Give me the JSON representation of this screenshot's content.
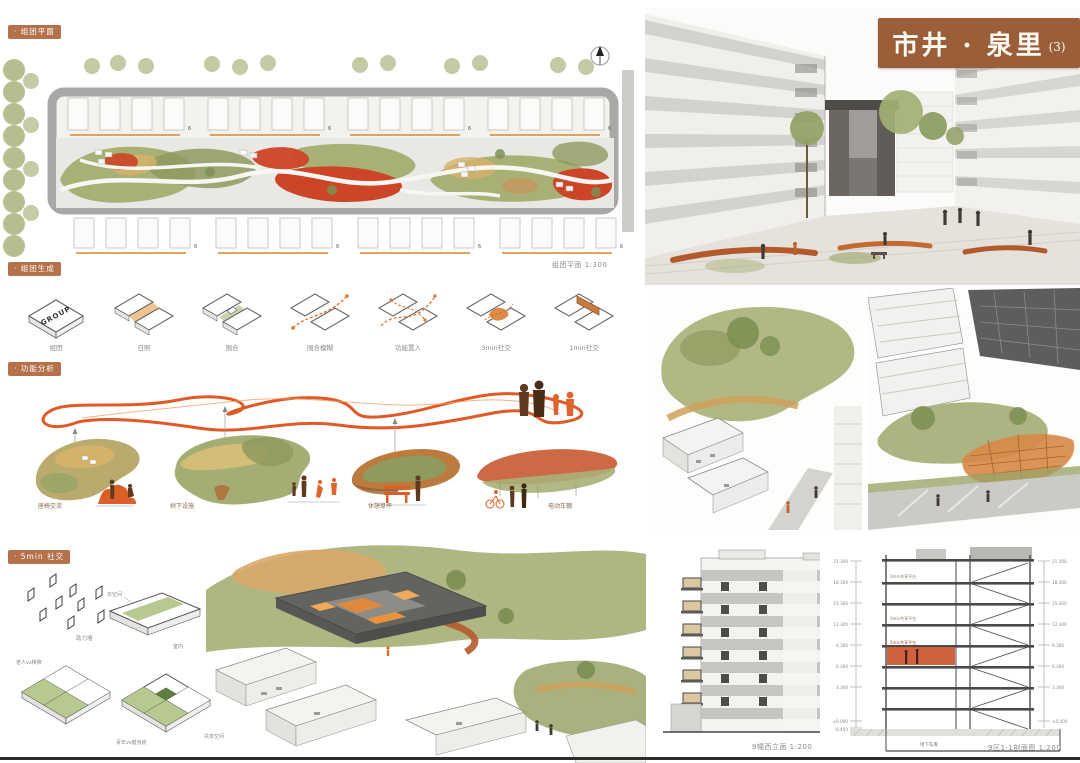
{
  "header": {
    "title": "市井 · 泉里",
    "title_no": "(3)"
  },
  "site_plan": {
    "badge": "· 组团平面",
    "caption": "组团平面 1:300",
    "unit_mark": "6"
  },
  "generation": {
    "badge": "· 组团生成",
    "group_text": "GROUP",
    "steps": [
      "组团",
      "日照",
      "围合",
      "围合模糊",
      "功能置入",
      "3min社交",
      "1min社交"
    ]
  },
  "function": {
    "badge": "· 功能分析",
    "items": [
      "座椅交流",
      "树下设施",
      "休憩草坪",
      "电动车棚"
    ]
  },
  "social": {
    "badge": "· 5min 社交",
    "wall": "助力墙",
    "gray_space": "灰空间",
    "indoor": "室内",
    "elder": "老人vs棋牌",
    "youth": "青年vs健身房",
    "shared": "共享空间"
  },
  "drawings": {
    "elevation_caption": "9幢西立面 1:200",
    "section_caption": "9区1-1剖面图 1:200",
    "basement": "地下车库",
    "levels": [
      "21.300",
      "18.300",
      "15.300",
      "12.300",
      "9.300",
      "6.300",
      "3.300",
      "±0.000",
      "-0.450"
    ],
    "floor_tags": [
      "3min共享平台",
      "3min共享平台",
      "5min共享平台"
    ]
  },
  "colors": {
    "accent_brown": "#9a5e39",
    "badge": "#b4714a",
    "olive": "#a9b076",
    "dark_olive": "#8f9a5f",
    "tan": "#d7b26c",
    "red": "#cc4526",
    "rust": "#b65a2e",
    "orange": "#e0762e"
  }
}
